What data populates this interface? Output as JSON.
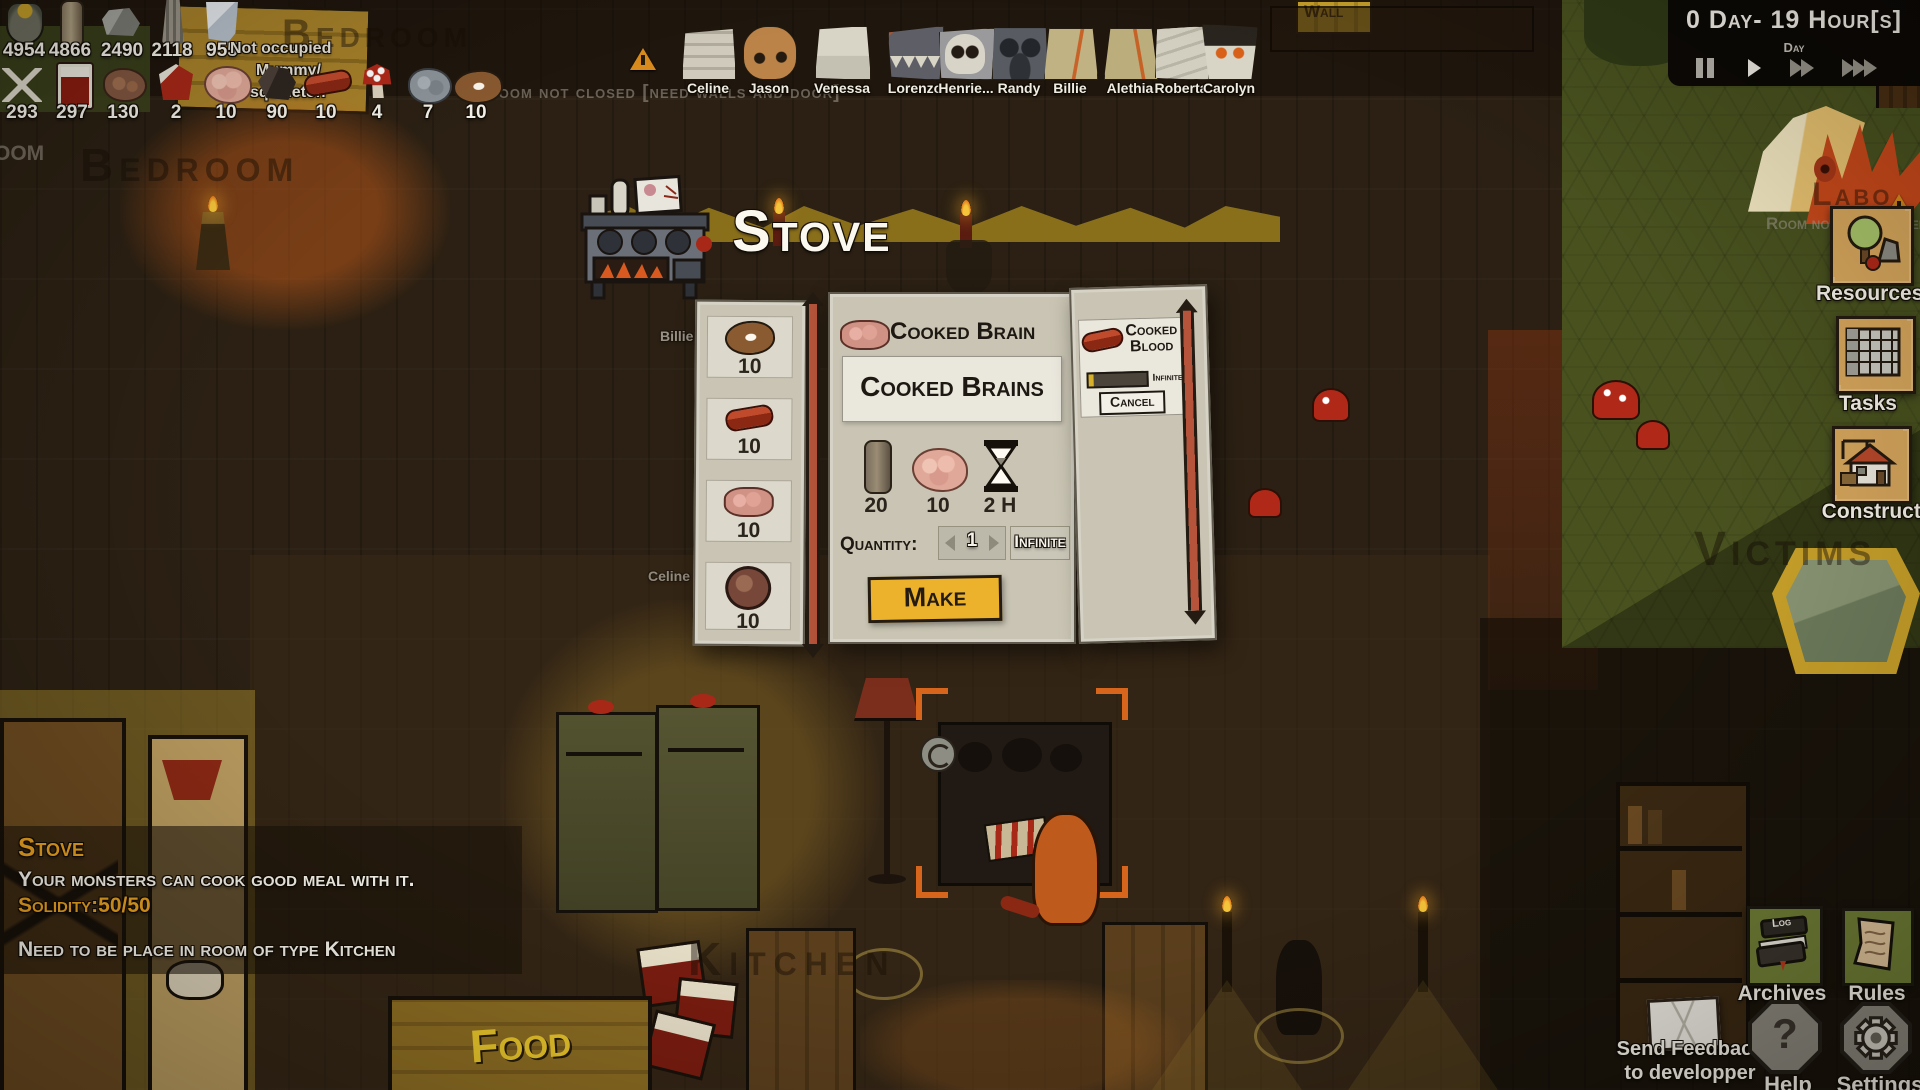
{
  "hud": {
    "row1": [
      {
        "icon": "money-bag",
        "value": "4954"
      },
      {
        "icon": "wood-log",
        "value": "4866"
      },
      {
        "icon": "stone",
        "value": "2490"
      },
      {
        "icon": "plant-fiber",
        "value": "2118"
      },
      {
        "icon": "glass",
        "value": "955"
      }
    ],
    "row2": [
      {
        "icon": "bones",
        "value": "293"
      },
      {
        "icon": "blood-jar",
        "value": "297"
      },
      {
        "icon": "raw-meat",
        "value": "130"
      },
      {
        "icon": "meat-bait",
        "value": "2"
      },
      {
        "icon": "brain",
        "value": "10"
      },
      {
        "icon": "dark-meat",
        "value": "90"
      },
      {
        "icon": "sausage",
        "value": "10"
      },
      {
        "icon": "mushroom",
        "value": "4"
      },
      {
        "icon": "gray-brain",
        "value": "7"
      },
      {
        "icon": "steak",
        "value": "10"
      }
    ]
  },
  "map_labels": {
    "not_occupied": "Not occupied",
    "mummy_line1": "Mummy/",
    "mummy_line2": "squeleton",
    "room_not_closed": "Room not closed [need walls and door]",
    "bedroom_top": "Bedroom",
    "bedroom_left": "Bedroom",
    "room_partial": "oom",
    "kitchen": "Kitchen",
    "victims": "Victims",
    "wall": "Wall",
    "laboratory": "Labo",
    "food": "Food"
  },
  "monsters": [
    {
      "name": "Celine"
    },
    {
      "name": "Jason"
    },
    {
      "name": "Venessa"
    },
    {
      "name": "Lorenzo"
    },
    {
      "name": "Henrie..."
    },
    {
      "name": "Randy"
    },
    {
      "name": "Billie"
    },
    {
      "name": "Alethia"
    },
    {
      "name": "Roberta"
    },
    {
      "name": "Carolyn"
    }
  ],
  "clock": {
    "time": "0 Day- 19 Hour[s]",
    "speed_label": "Day"
  },
  "stove_window": {
    "title": "Stove",
    "inventory": [
      {
        "icon": "steak",
        "qty": "10"
      },
      {
        "icon": "sausage",
        "qty": "10"
      },
      {
        "icon": "cooked-brain",
        "qty": "10"
      },
      {
        "icon": "raw-meat-ball",
        "qty": "10"
      }
    ],
    "recipe": {
      "name": "Cooked Brain",
      "product": "Cooked Brains",
      "ingredients": [
        {
          "icon": "wood-log",
          "value": "20"
        },
        {
          "icon": "brain",
          "value": "10"
        },
        {
          "icon": "hourglass",
          "value": "2 H"
        }
      ],
      "quantity_label": "Quantity:",
      "quantity_value": "1",
      "infinite_label": "Infinite",
      "make_label": "Make"
    },
    "queue": {
      "item_name": "Cooked Blood",
      "infinite_label": "Infinite",
      "cancel_label": "Cancel"
    }
  },
  "tooltip": {
    "title": "Stove",
    "description": "Your monsters can cook good meal with it.",
    "solidity": "Solidity:50/50",
    "requirement": "Need to be place in room of type Kitchen"
  },
  "sidebar": {
    "items": [
      {
        "label": "Resources"
      },
      {
        "label": "Tasks"
      },
      {
        "label": "Construction"
      }
    ]
  },
  "corner_menu": {
    "archives": "Archives",
    "rules": "Rules",
    "help": "Help",
    "settings": "Settings",
    "feedback_line1": "Send Feedback",
    "feedback_line2": "to developper",
    "log_label": "Log",
    "help_glyph": "?"
  }
}
